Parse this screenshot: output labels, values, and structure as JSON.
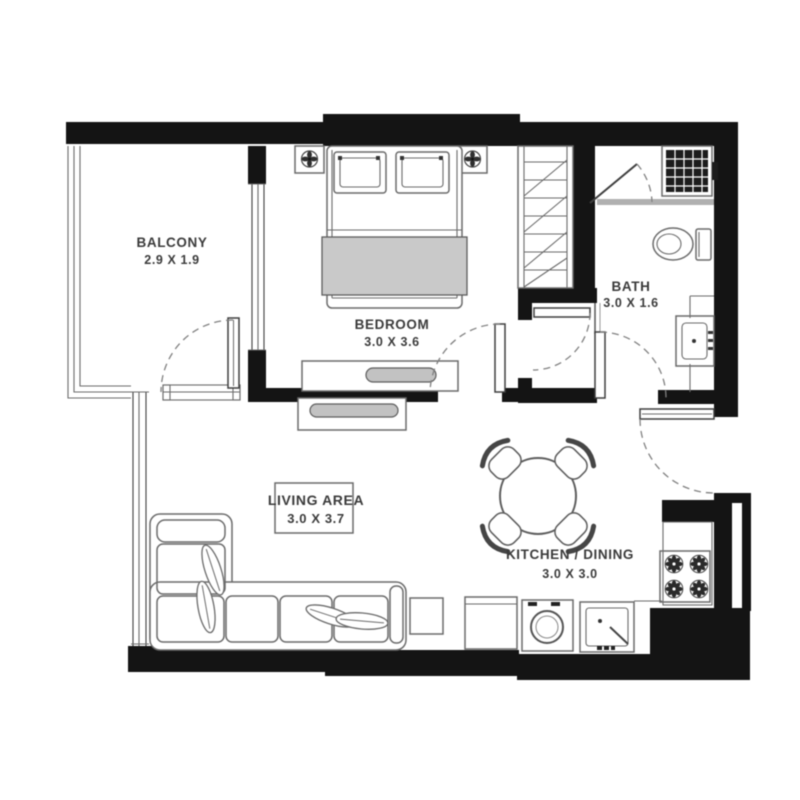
{
  "rooms": [
    {
      "name": "BALCONY",
      "dims": "2.9 X 1.9"
    },
    {
      "name": "BEDROOM",
      "dims": "3.0 X 3.6"
    },
    {
      "name": "BATH",
      "dims": "3.0 X 1.6"
    },
    {
      "name": "LIVING AREA",
      "dims": "3.0 X 3.7"
    },
    {
      "name": "KITCHEN / DINING",
      "dims": "3.0 X 3.0"
    }
  ],
  "colors": {
    "wall": "#141414",
    "line": "#6b6b6b",
    "shade": "#c9c9c9",
    "background": "#ffffff",
    "text": "#3b3b3b"
  }
}
